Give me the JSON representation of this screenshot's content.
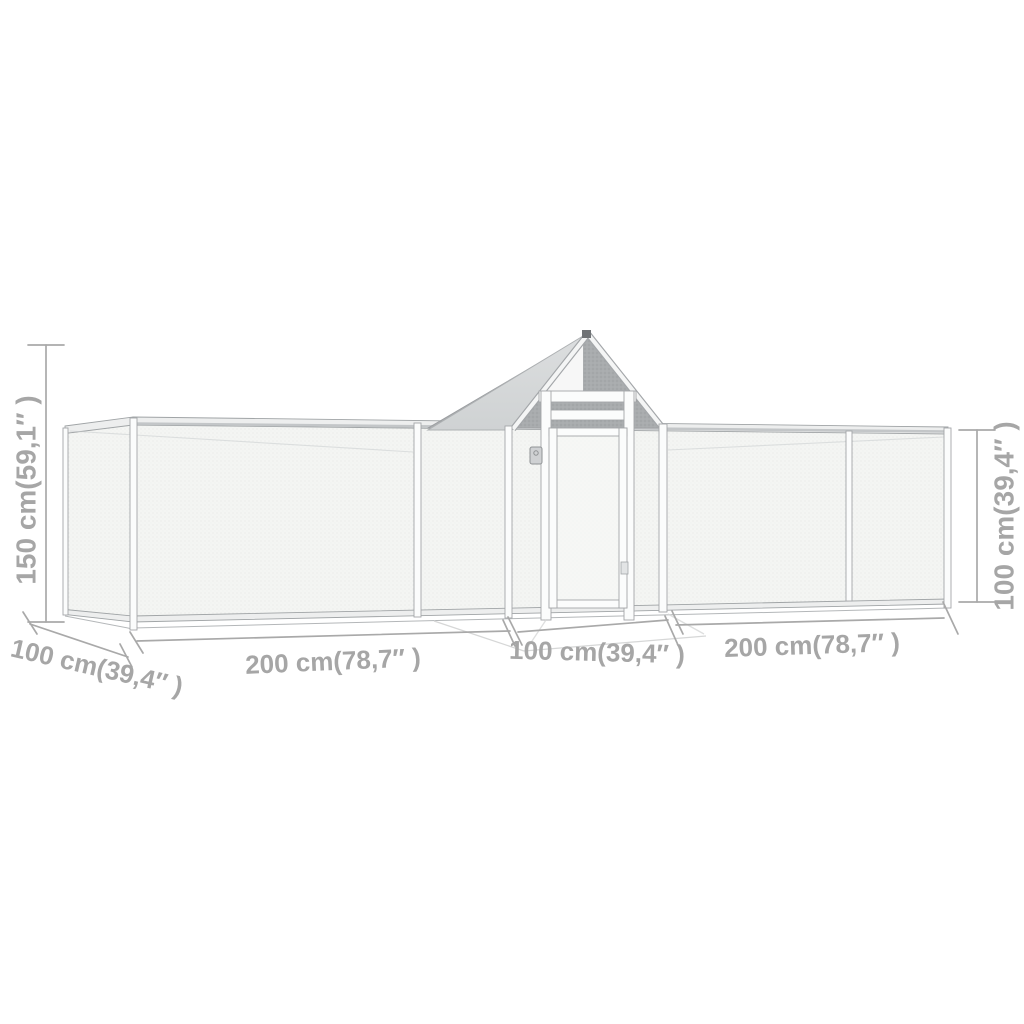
{
  "page": {
    "background": "#ffffff"
  },
  "diagram": {
    "type": "product-dimension-drawing",
    "subject": "chicken-coop-with-run",
    "colors": {
      "dimension_text": "#a6a6a6",
      "dimension_line": "#a9a9a9",
      "frame_line": "#a3a6a9",
      "frame_fill": "#fbfcfc",
      "rail_fill": "#edeeee",
      "mesh_fill": "#f4f5f3",
      "roof_light": "#d6d8d9",
      "roof_dark": "#a9acae",
      "background": "#ffffff"
    },
    "dimensions": {
      "total_height": {
        "label": "150 cm(59,1″ )",
        "cm": 150,
        "inch": "59,1",
        "position": "left-vertical"
      },
      "side_height": {
        "label": "100 cm(39,4″ )",
        "cm": 100,
        "inch": "39,4",
        "position": "right-vertical"
      },
      "depth": {
        "label": "100 cm(39,4″ )",
        "cm": 100,
        "inch": "39,4",
        "position": "bottom-left-diagonal"
      },
      "left_section_length": {
        "label": "200 cm(78,7″ )",
        "cm": 200,
        "inch": "78,7",
        "position": "bottom-left"
      },
      "middle_section_length": {
        "label": "100 cm(39,4″ )",
        "cm": 100,
        "inch": "39,4",
        "position": "bottom-middle"
      },
      "right_section_length": {
        "label": "200 cm(78,7″ )",
        "cm": 200,
        "inch": "78,7",
        "position": "bottom-right"
      }
    }
  }
}
